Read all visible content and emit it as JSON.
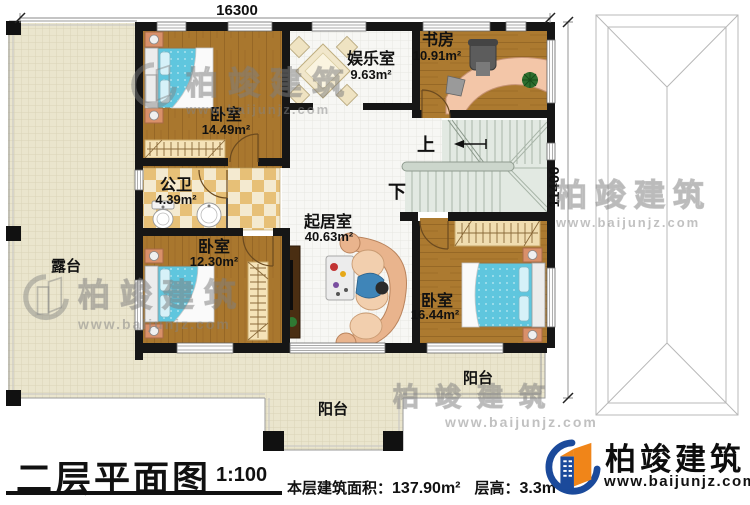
{
  "dimensions": {
    "width_mm": "16300",
    "height_mm": "11400"
  },
  "rooms": {
    "bedroom_a": {
      "name": "卧室",
      "area": "14.49m²"
    },
    "entertainment": {
      "name": "娱乐室",
      "area": "9.63m²"
    },
    "study": {
      "name": "书房",
      "area": "10.91m²"
    },
    "bathroom": {
      "name": "公卫",
      "area": "4.39m²"
    },
    "living": {
      "name": "起居室",
      "area": "40.63m²"
    },
    "bedroom_b": {
      "name": "卧室",
      "area": "12.30m²"
    },
    "bedroom_c": {
      "name": "卧室",
      "area": "16.44m²"
    },
    "terrace": {
      "name": "露台"
    },
    "balcony_bottom": {
      "name": "阳台"
    },
    "balcony_right": {
      "name": "阳台"
    }
  },
  "stairs": {
    "up_label": "上",
    "down_label": "下"
  },
  "footer": {
    "title": "二层平面图",
    "scale": "1:100",
    "floor_area_label": "本层建筑面积：",
    "floor_area_value": "137.90m²",
    "floor_height_label": "层高：",
    "floor_height_value": "3.3m"
  },
  "brand": {
    "name": "柏竣建筑",
    "website": "www.baijunjz.com"
  },
  "watermark": {
    "name": "柏竣建筑",
    "website": "www.baijunjz.com"
  },
  "colors": {
    "wall": "#161616",
    "wood_floor": "#a9772e",
    "terrace_floor": "#eae5cd",
    "bed": "#5fc6de",
    "stair": "#e2e9e2",
    "checker": "#e7c077",
    "brand_blue": "#1b4a9b",
    "brand_orange": "#f08519"
  }
}
